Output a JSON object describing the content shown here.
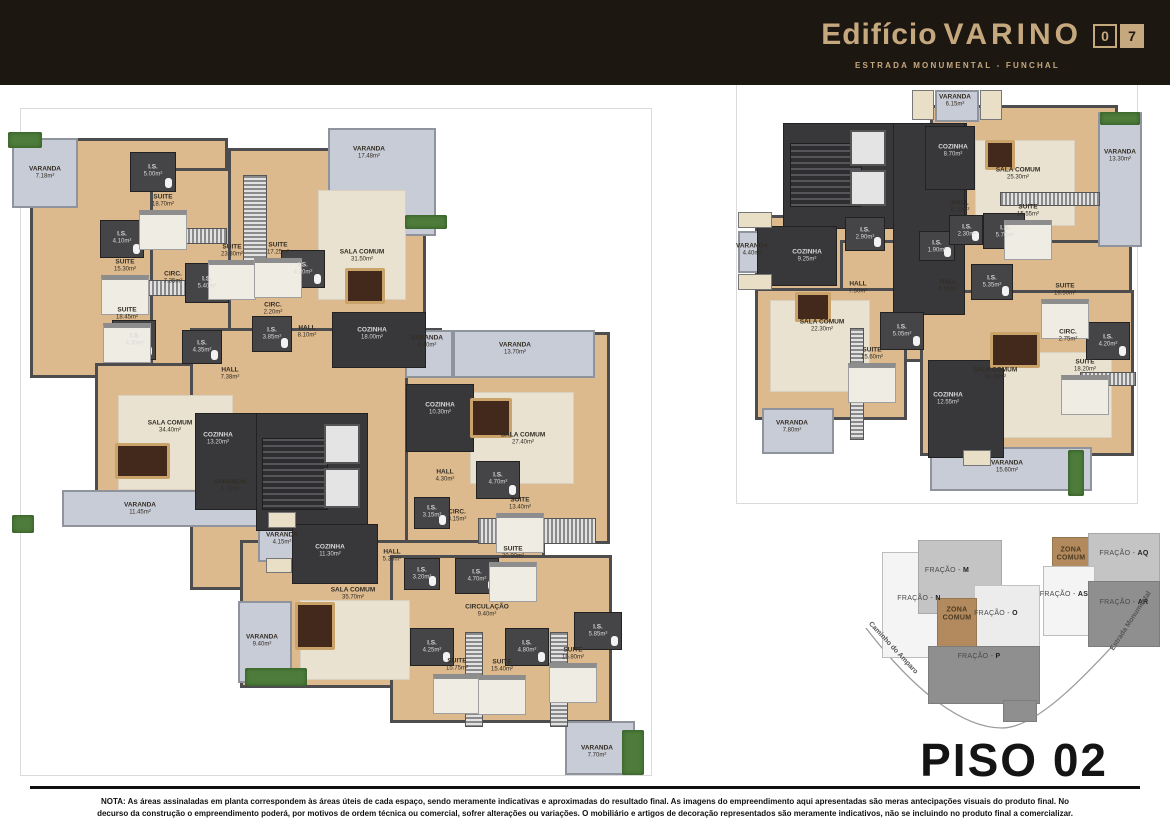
{
  "header": {
    "title_prefix": "Edifício",
    "title_name": "VARINO",
    "badge": "07",
    "subtitle": "ESTRADA MONUMENTAL - FUNCHAL",
    "bg_color": "#1D1712",
    "accent_color": "#C6A87E"
  },
  "floor_title": "PISO 02",
  "note": "NOTA: As áreas assinaladas em planta correspondem às áreas úteis de cada espaço, sendo meramente indicativas e aproximadas do resultado final. As imagens do empreendimento aqui apresentadas são meras antecipações visuais do produto final. No decurso da construção o empreendimento poderá, por motivos de ordem técnica ou comercial, sofrer alterações ou variações. O mobiliário e artigos de decoração representados são meramente indicativos, não se incluindo no produto final a comercializar.",
  "palette": {
    "floor_wood": "#DCBA8E",
    "balcony": "#C8CCD6",
    "service_core": "#38383B",
    "zona_comum": "#B28A5E"
  },
  "left_plan": {
    "rooms": [
      {
        "name": "VARANDA",
        "area": "7.18m²"
      },
      {
        "name": "I.S.",
        "area": "5.00m²"
      },
      {
        "name": "SUITE",
        "area": "18.70m²"
      },
      {
        "name": "I.S.",
        "area": "4.10m²"
      },
      {
        "name": "SUITE",
        "area": "15.30m²"
      },
      {
        "name": "CIRC.",
        "area": "7.35m²"
      },
      {
        "name": "I.S.",
        "area": "5.40m²"
      },
      {
        "name": "SUITE",
        "area": "18.45m²"
      },
      {
        "name": "I.S.",
        "area": "4.30m²"
      },
      {
        "name": "VARANDA",
        "area": "17.48m²"
      },
      {
        "name": "SUITE",
        "area": "23.80m²"
      },
      {
        "name": "SUITE",
        "area": "17.25m²"
      },
      {
        "name": "I.S.",
        "area": "4.20m²"
      },
      {
        "name": "SALA COMUM",
        "area": "31.50m²"
      },
      {
        "name": "CIRC.",
        "area": "2.20m²"
      },
      {
        "name": "I.S.",
        "area": "3.85m²"
      },
      {
        "name": "HALL",
        "area": "8.10m²"
      },
      {
        "name": "COZINHA",
        "area": "18.00m²"
      },
      {
        "name": "I.S.",
        "area": "4.35m²"
      },
      {
        "name": "HALL",
        "area": "7.38m²"
      },
      {
        "name": "SALA COMUM",
        "area": "34.40m²"
      },
      {
        "name": "COZINHA",
        "area": "13.20m²"
      },
      {
        "name": "VARANDA",
        "area": "6.15m²"
      },
      {
        "name": "VARANDA",
        "area": "11.45m²"
      },
      {
        "name": "VARANDA",
        "area": "4.15m²"
      },
      {
        "name": "COZINHA",
        "area": "11.30m²"
      },
      {
        "name": "VARANDA",
        "area": "4.40m²"
      },
      {
        "name": "VARANDA",
        "area": "13.70m²"
      },
      {
        "name": "COZINHA",
        "area": "10.30m²"
      },
      {
        "name": "SALA COMUM",
        "area": "27.40m²"
      },
      {
        "name": "HALL",
        "area": "4.30m²"
      },
      {
        "name": "I.S.",
        "area": "4.70m²"
      },
      {
        "name": "SUITE",
        "area": "13.40m²"
      },
      {
        "name": "I.S.",
        "area": "3.15m²"
      },
      {
        "name": "CIRC.",
        "area": "3.15m²"
      },
      {
        "name": "SUITE",
        "area": "20.90m²"
      },
      {
        "name": "I.S.",
        "area": "4.70m²"
      },
      {
        "name": "HALL",
        "area": "5.35m²"
      },
      {
        "name": "I.S.",
        "area": "3.20m²"
      },
      {
        "name": "SALA COMUM",
        "area": "35.70m²"
      },
      {
        "name": "VARANDA",
        "area": "9.40m²"
      },
      {
        "name": "I.S.",
        "area": "4.25m²"
      },
      {
        "name": "SUITE",
        "area": "15.75m²"
      },
      {
        "name": "CIRCULAÇÃO",
        "area": "9.40m²"
      },
      {
        "name": "I.S.",
        "area": "4.80m²"
      },
      {
        "name": "SUITE",
        "area": "15.40m²"
      },
      {
        "name": "I.S.",
        "area": "5.85m²"
      },
      {
        "name": "SUITE",
        "area": "16.80m²"
      },
      {
        "name": "VARANDA",
        "area": "7.70m²"
      }
    ]
  },
  "right_plan": {
    "rooms": [
      {
        "name": "VARANDA",
        "area": "6.15m²"
      },
      {
        "name": "COZINHA",
        "area": "8.70m²"
      },
      {
        "name": "HALL",
        "area": "6.15m²"
      },
      {
        "name": "I.S.",
        "area": "2.90m²"
      },
      {
        "name": "COZINHA",
        "area": "9.25m²"
      },
      {
        "name": "I.S.",
        "area": "1.90m²"
      },
      {
        "name": "HALL",
        "area": "7.50m²"
      },
      {
        "name": "HALL",
        "area": "6.65m²"
      },
      {
        "name": "I.S.",
        "area": "5.70m²"
      },
      {
        "name": "I.S.",
        "area": "2.30m²"
      },
      {
        "name": "SALA COMUM",
        "area": "25.30m²"
      },
      {
        "name": "VARANDA",
        "area": "13.30m²"
      },
      {
        "name": "SUITE",
        "area": "15.55m²"
      },
      {
        "name": "I.S.",
        "area": "5.35m²"
      },
      {
        "name": "SUITE",
        "area": "16.50m²"
      },
      {
        "name": "SALA COMUM",
        "area": "22.30m²"
      },
      {
        "name": "I.S.",
        "area": "5.05m²"
      },
      {
        "name": "SUITE",
        "area": "15.60m²"
      },
      {
        "name": "COZINHA",
        "area": "12.55m²"
      },
      {
        "name": "VARANDA",
        "area": "7.80m²"
      },
      {
        "name": "CIRC.",
        "area": "2.75m²"
      },
      {
        "name": "I.S.",
        "area": "4.20m²"
      },
      {
        "name": "SUITE",
        "area": "18.20m²"
      },
      {
        "name": "SALA COMUM",
        "area": "34.35m²"
      },
      {
        "name": "VARANDA",
        "area": "15.60m²"
      },
      {
        "name": "VARANDA",
        "area": "4.40m²"
      }
    ]
  },
  "key_plan": {
    "labels": [
      "FRAÇÃO - M",
      "FRAÇÃO - N",
      "ZONA COMUM",
      "FRAÇÃO - O",
      "FRAÇÃO - P",
      "ZONA COMUM",
      "FRAÇÃO - AQ",
      "FRAÇÃO - AS",
      "FRAÇÃO - AR"
    ],
    "roads": [
      "Caminho do Amparo",
      "Estrada Monumental"
    ]
  }
}
